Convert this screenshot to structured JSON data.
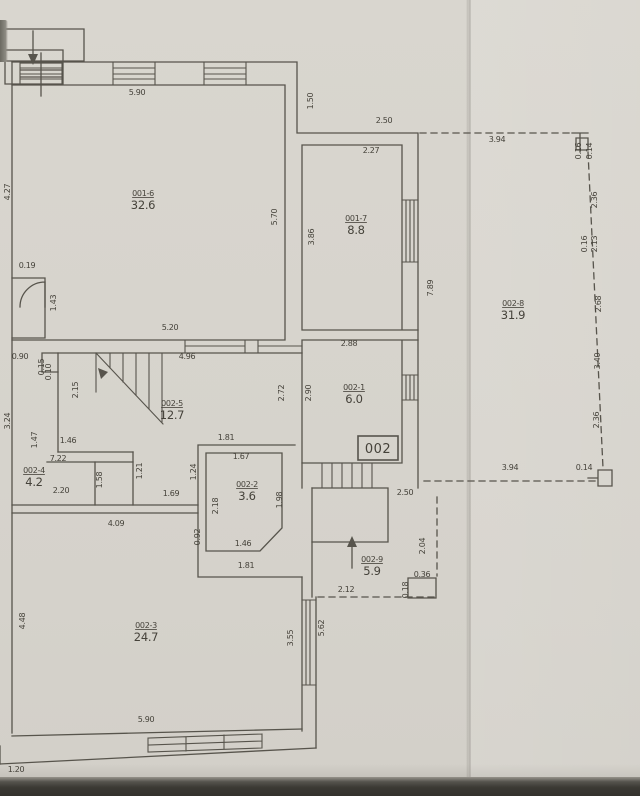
{
  "document": {
    "type": "scanned floor plan",
    "unit_box_label": "002"
  },
  "palette": {
    "paper": "#d7d4cd",
    "line": "#57544c",
    "text": "#45423a",
    "bottom_strip": "#3b3934"
  },
  "rooms": [
    {
      "code": "001-6",
      "area": "32.6",
      "x": 143,
      "y": 196
    },
    {
      "code": "001-7",
      "area": "8.8",
      "x": 356,
      "y": 221
    },
    {
      "code": "002-8",
      "area": "31.9",
      "x": 513,
      "y": 306
    },
    {
      "code": "002-5",
      "area": "12.7",
      "x": 172,
      "y": 406
    },
    {
      "code": "002-1",
      "area": "6.0",
      "x": 354,
      "y": 390
    },
    {
      "code": "002-4",
      "area": "4.2",
      "x": 34,
      "y": 473
    },
    {
      "code": "002-2",
      "area": "3.6",
      "x": 247,
      "y": 487
    },
    {
      "code": "002-9",
      "area": "5.9",
      "x": 372,
      "y": 562
    },
    {
      "code": "002-3",
      "area": "24.7",
      "x": 146,
      "y": 628
    }
  ],
  "dimensions": [
    {
      "v": "5.90",
      "x": 137,
      "y": 95,
      "r": 0
    },
    {
      "v": "1.50",
      "x": 313,
      "y": 101,
      "r": 90
    },
    {
      "v": "2.50",
      "x": 384,
      "y": 123,
      "r": 0
    },
    {
      "v": "2.27",
      "x": 371,
      "y": 153,
      "r": 0
    },
    {
      "v": "3.94",
      "x": 497,
      "y": 142,
      "r": 0
    },
    {
      "v": "0.16",
      "x": 581,
      "y": 151,
      "r": 90,
      "s": 6.5
    },
    {
      "v": "0.14",
      "x": 592,
      "y": 151,
      "r": 90,
      "s": 6.5
    },
    {
      "v": "4.27",
      "x": 10,
      "y": 192,
      "r": 90
    },
    {
      "v": "5.70",
      "x": 277,
      "y": 217,
      "r": 90
    },
    {
      "v": "3.86",
      "x": 314,
      "y": 237,
      "r": 90
    },
    {
      "v": "7.89",
      "x": 433,
      "y": 288,
      "r": 90
    },
    {
      "v": "2.36",
      "x": 597,
      "y": 200,
      "r": 90
    },
    {
      "v": "0.16",
      "x": 587,
      "y": 244,
      "r": 90,
      "s": 6.5
    },
    {
      "v": "2.13",
      "x": 597,
      "y": 244,
      "r": 90,
      "s": 6.5
    },
    {
      "v": "2.68",
      "x": 601,
      "y": 304,
      "r": 90
    },
    {
      "v": "3.40",
      "x": 600,
      "y": 361,
      "r": 90
    },
    {
      "v": "2.36",
      "x": 599,
      "y": 420,
      "r": 90
    },
    {
      "v": "0.14",
      "x": 584,
      "y": 470,
      "r": 0,
      "s": 6.5
    },
    {
      "v": "0.19",
      "x": 27,
      "y": 268,
      "r": 0,
      "s": 7
    },
    {
      "v": "1.43",
      "x": 56,
      "y": 303,
      "r": 90
    },
    {
      "v": "5.20",
      "x": 170,
      "y": 330,
      "r": 0
    },
    {
      "v": "2.88",
      "x": 349,
      "y": 346,
      "r": 0
    },
    {
      "v": "4.96",
      "x": 187,
      "y": 359,
      "r": 0
    },
    {
      "v": "0.90",
      "x": 20,
      "y": 359,
      "r": 0,
      "s": 6
    },
    {
      "v": "0.15",
      "x": 44,
      "y": 367,
      "r": 90,
      "s": 6
    },
    {
      "v": "0.10",
      "x": 51,
      "y": 372,
      "r": 90,
      "s": 6
    },
    {
      "v": "2.15",
      "x": 78,
      "y": 390,
      "r": 90
    },
    {
      "v": "2.72",
      "x": 284,
      "y": 393,
      "r": 90
    },
    {
      "v": "2.90",
      "x": 311,
      "y": 393,
      "r": 90
    },
    {
      "v": "3.24",
      "x": 10,
      "y": 421,
      "r": 90
    },
    {
      "v": "1.47",
      "x": 37,
      "y": 440,
      "r": 90
    },
    {
      "v": "1.46",
      "x": 68,
      "y": 443,
      "r": 0
    },
    {
      "v": "7.22",
      "x": 58,
      "y": 461,
      "r": 0
    },
    {
      "v": "1.81",
      "x": 226,
      "y": 440,
      "r": 0
    },
    {
      "v": "1.67",
      "x": 241,
      "y": 459,
      "r": 0
    },
    {
      "v": "1.24",
      "x": 196,
      "y": 472,
      "r": 90
    },
    {
      "v": "2.18",
      "x": 218,
      "y": 506,
      "r": 90
    },
    {
      "v": "1.98",
      "x": 282,
      "y": 500,
      "r": 90
    },
    {
      "v": "0.92",
      "x": 200,
      "y": 537,
      "r": 90,
      "s": 7
    },
    {
      "v": "1.58",
      "x": 102,
      "y": 480,
      "r": 90
    },
    {
      "v": "1.21",
      "x": 142,
      "y": 471,
      "r": 90
    },
    {
      "v": "1.69",
      "x": 171,
      "y": 496,
      "r": 0
    },
    {
      "v": "2.20",
      "x": 61,
      "y": 493,
      "r": 0
    },
    {
      "v": "4.09",
      "x": 116,
      "y": 526,
      "r": 0
    },
    {
      "v": "1.46",
      "x": 243,
      "y": 546,
      "r": 0
    },
    {
      "v": "1.81",
      "x": 246,
      "y": 568,
      "r": 0
    },
    {
      "v": "2.50",
      "x": 405,
      "y": 495,
      "r": 0
    },
    {
      "v": "2.04",
      "x": 425,
      "y": 546,
      "r": 90
    },
    {
      "v": "0.36",
      "x": 422,
      "y": 577,
      "r": 0,
      "s": 6.5
    },
    {
      "v": "0.18",
      "x": 408,
      "y": 590,
      "r": 90,
      "s": 6.5
    },
    {
      "v": "2.12",
      "x": 346,
      "y": 592,
      "r": 0
    },
    {
      "v": "3.94",
      "x": 510,
      "y": 470,
      "r": 0
    },
    {
      "v": "4.48",
      "x": 25,
      "y": 621,
      "r": 90
    },
    {
      "v": "3.55",
      "x": 293,
      "y": 638,
      "r": 90
    },
    {
      "v": "5.62",
      "x": 324,
      "y": 628,
      "r": 90
    },
    {
      "v": "5.90",
      "x": 146,
      "y": 722,
      "r": 0
    },
    {
      "v": "1.20",
      "x": 16,
      "y": 772,
      "r": 0
    }
  ]
}
